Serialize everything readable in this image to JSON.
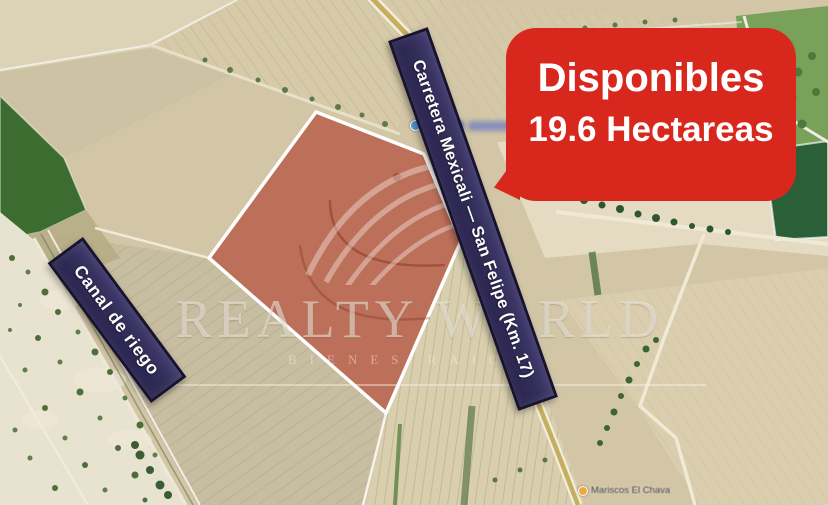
{
  "badge": {
    "title": "Disponibles",
    "subtitle": "19.6 Hectareas",
    "bg_color": "#d8281e",
    "text_color": "#ffffff"
  },
  "banners": {
    "road": {
      "label": "Carretera Mexicali — San Felipe (Km. 17)",
      "bg_color": "#332e58",
      "border_color": "#171330",
      "text_color": "#ffffff"
    },
    "canal": {
      "label": "Canal de riego",
      "bg_color": "#332e58",
      "border_color": "#171330",
      "text_color": "#ffffff"
    }
  },
  "parcel": {
    "fill_color": "rgba(172,42,26,0.55)",
    "stroke_color": "#ffffff"
  },
  "watermark": {
    "brand": "REALTY WORLD",
    "tagline": "BIENES RAICES"
  },
  "map_labels": {
    "poi_bottom": "Mariscos El Chava"
  }
}
